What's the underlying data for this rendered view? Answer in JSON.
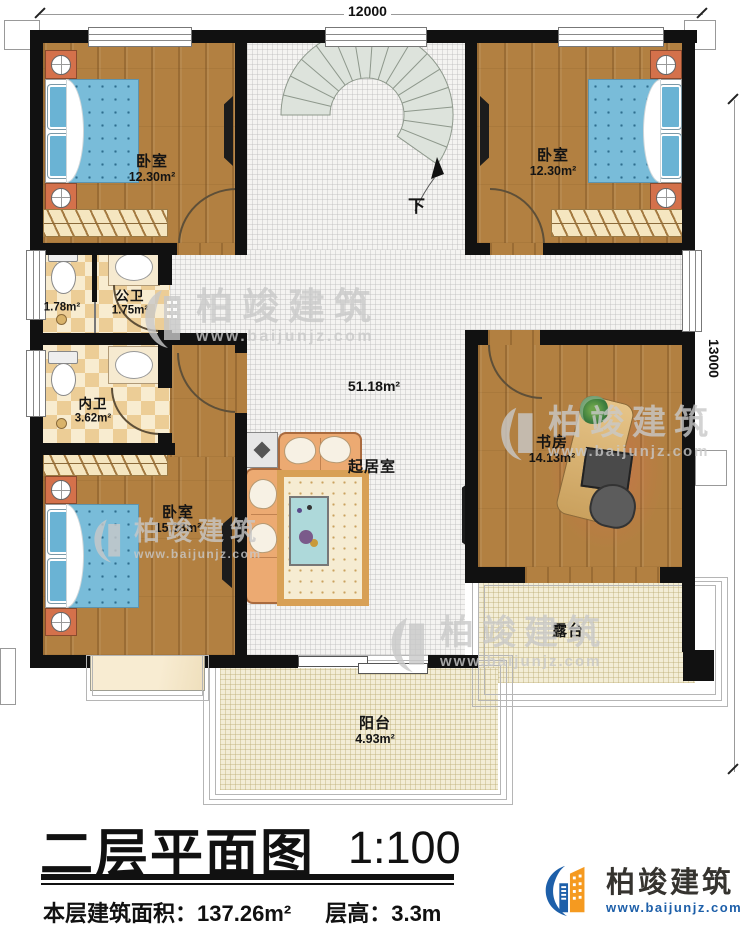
{
  "dimensions": {
    "width_mm": "12000",
    "height_mm": "13000"
  },
  "stairs": {
    "down_label": "下"
  },
  "rooms": {
    "bedroom_top_left": {
      "name": "卧室",
      "area": "12.30m²"
    },
    "bedroom_top_right": {
      "name": "卧室",
      "area": "12.30m²"
    },
    "bedroom_bottom_left": {
      "name": "卧室",
      "area": "15.38m²"
    },
    "public_bathroom": {
      "name": "公卫",
      "area": "1.75m²",
      "compartment_area": "1.78m²"
    },
    "ensuite_bathroom": {
      "name": "内卫",
      "area": "3.62m²"
    },
    "living_room": {
      "name": "起居室",
      "area": "51.18m²"
    },
    "study": {
      "name": "书房",
      "area": "14.13m²"
    },
    "terrace": {
      "name": "露台"
    },
    "balcony": {
      "name": "阳台",
      "area": "4.93m²"
    }
  },
  "title_block": {
    "title": "二层平面图",
    "scale": "1:100",
    "floor_area_label": "本层建筑面积：",
    "floor_area": "137.26m²",
    "story_height_label": "层高：",
    "story_height": "3.3m"
  },
  "brand": {
    "name": "柏竣建筑",
    "website": "www.baijunjz.com"
  },
  "watermark": {
    "name": "柏竣建筑",
    "website": "www.baijunjz.com"
  },
  "colors": {
    "wall": "#111111",
    "wood_floor": "#b28041",
    "tile_floor": "#f4f3f1",
    "bathroom_tile": "#eccd96",
    "bed": "#79bcd9",
    "brand_blue": "#1d5fa9",
    "brand_orange": "#f59a20"
  }
}
